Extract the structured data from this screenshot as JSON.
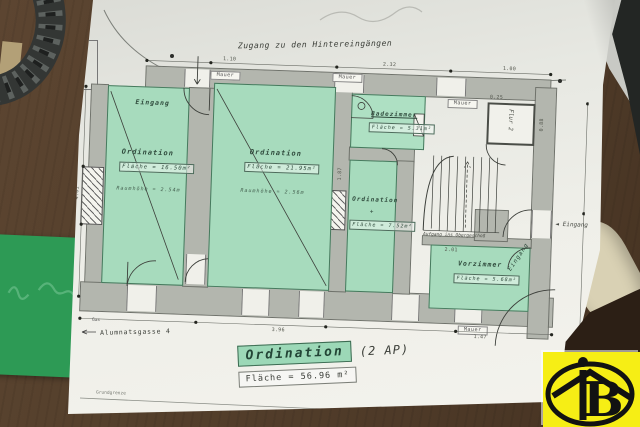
{
  "plan": {
    "top_note": "Zugang zu den Hintereingängen",
    "exit_label": "Ausgang",
    "street_label": "Alumnatsgasse 4",
    "gas_label": "Gas",
    "boundary_label": "Grundgrenze",
    "mauer_label": "Mauer",
    "stairs_note": "Aufgang ins Obergeschoß",
    "entrance_arrow_label": "Eingang",
    "plus_mark": "+",
    "rooms": [
      {
        "name": "Ordination",
        "area": "Fläche = 16.50m²",
        "height": "Raumhöhe = 2.54m",
        "entrance": "Eingang"
      },
      {
        "name": "Ordination",
        "area": "Fläche = 21.95m²",
        "height": "Raumhöhe = 2.56m"
      },
      {
        "name": "Badezimmer",
        "area": "Fläche = 5.31m²"
      },
      {
        "name": "Ordination",
        "area": "Fläche = 7.52m²"
      },
      {
        "name": "Vorzimmer",
        "area": "Fläche = 5.68m²",
        "entrance": "Eingang"
      },
      {
        "name": "Flur 2"
      }
    ],
    "dims": [
      "1.10",
      "2.32",
      "1.00",
      "4.01",
      "1.87",
      "0.88",
      "3.96",
      "1.47",
      "2.01",
      "0.25"
    ],
    "title_block": {
      "name": "Ordination",
      "suffix": "(2 AP)",
      "area": "Fläche = 56.96 m²"
    }
  },
  "logo": {
    "letter": "B"
  },
  "colors": {
    "room_green": "#a7dbbd",
    "wall_gray": "#b3b6ae",
    "paper": "#efefe9",
    "desk_brown": "#55402c",
    "note_card_green": "#2d9a55",
    "logo_yellow": "#f6ee15"
  }
}
